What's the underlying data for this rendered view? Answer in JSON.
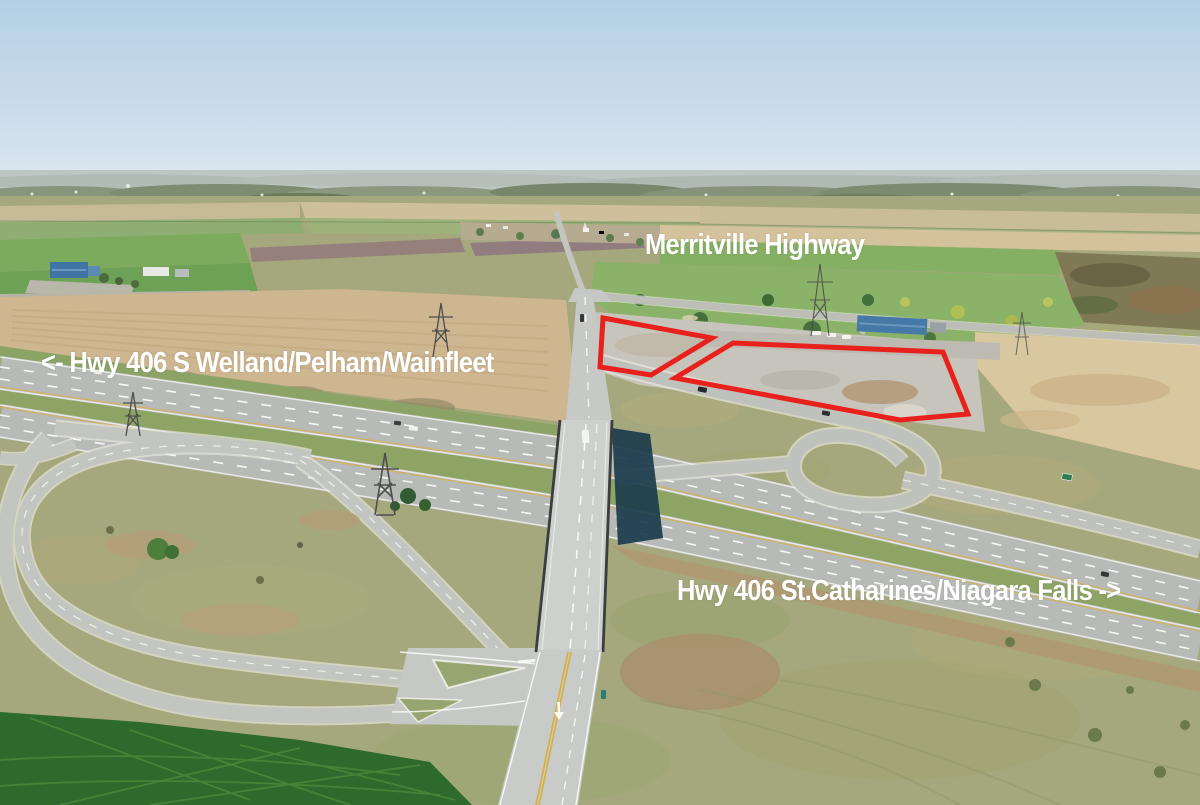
{
  "image": {
    "width": 1200,
    "height": 805
  },
  "labels": {
    "top_road": "Merritville Highway",
    "west_direction": "<- Hwy 406 S Welland/Pelham/Wainfleet",
    "east_direction": "Hwy 406 St.Catharines/Niagara Falls ->"
  },
  "colors": {
    "overlay-text": "#ffffff",
    "parcel-outline": "#e8211d",
    "sky-top": "#b4d0e4",
    "sky-horizon": "#e0eaf1"
  },
  "parcels": {
    "left_points": "603,318 712,338 651,375 600,367",
    "right_points": "733,343 943,352 968,414 900,420 820,405 675,378"
  }
}
